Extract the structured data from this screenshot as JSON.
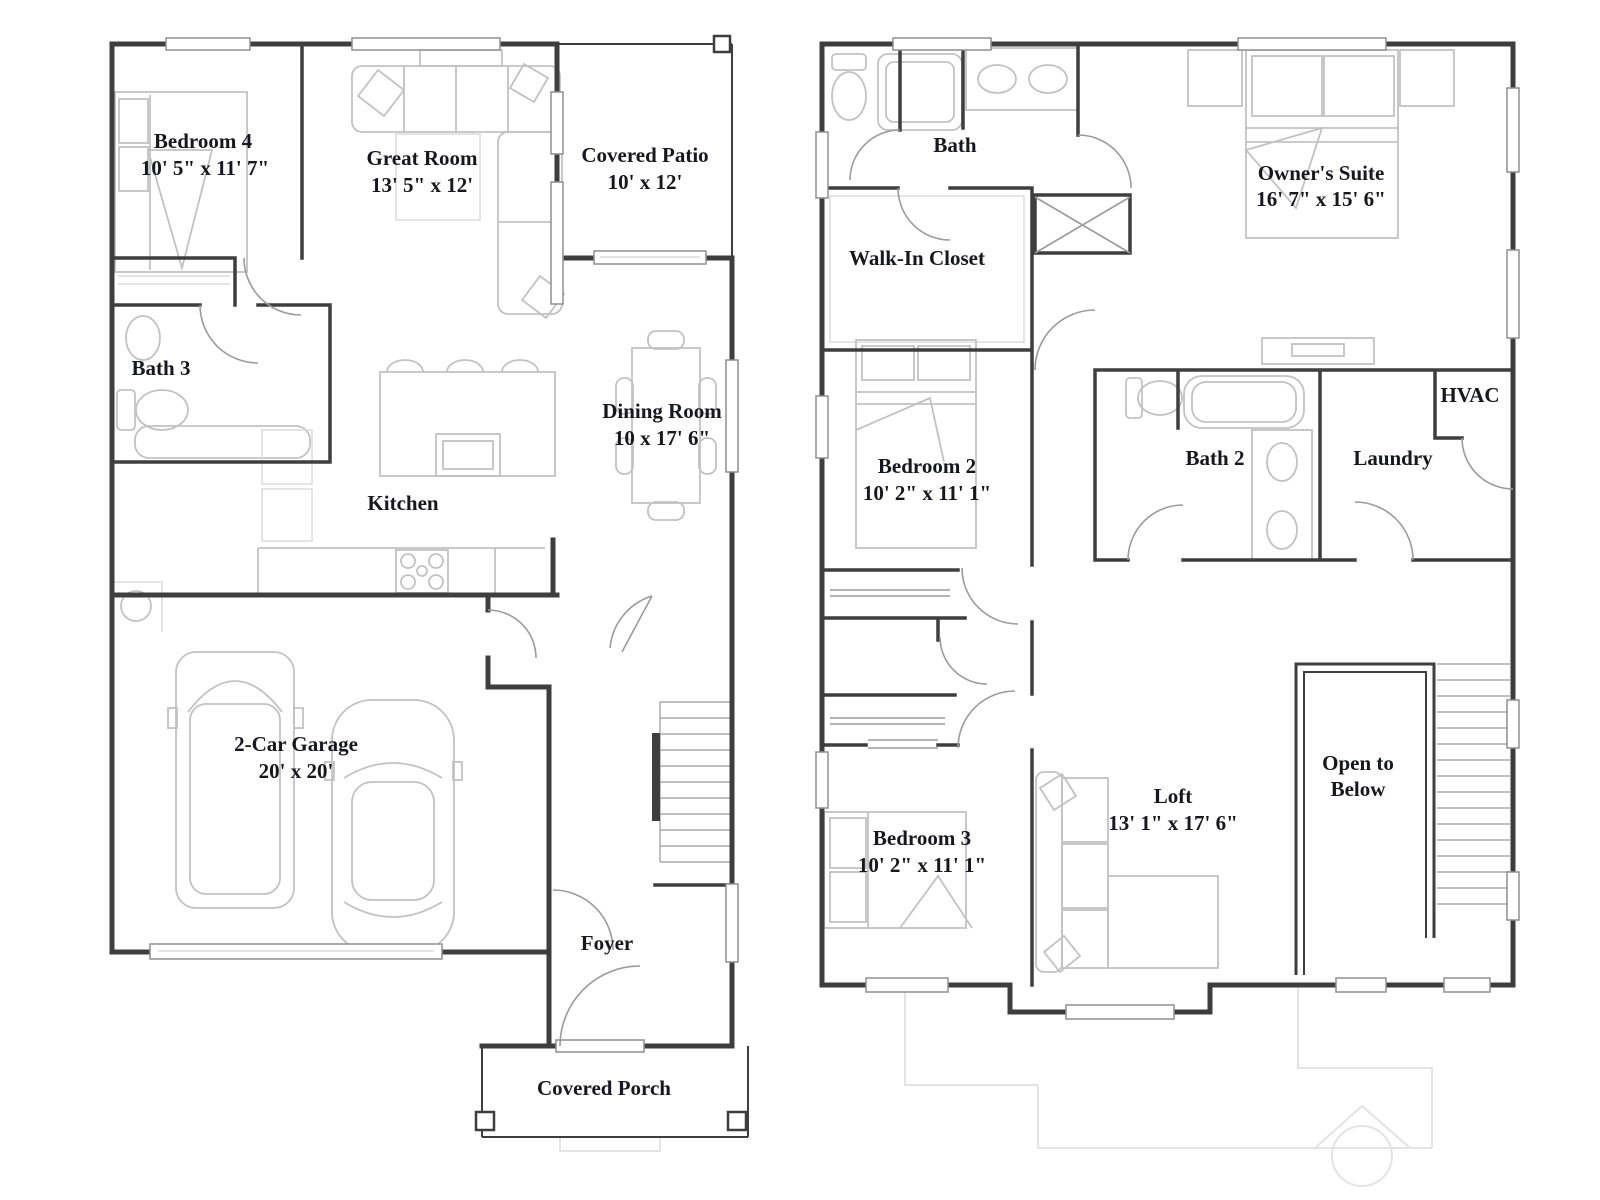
{
  "palette": {
    "background": "#ffffff",
    "wall": "#3e3e3e",
    "fixture": "#c2c2c2",
    "fixture_light": "#dcdcdc",
    "door": "#9b9b9b",
    "window_stroke": "#8f8f8f",
    "ghost": "#e3e3e3",
    "label": "#17171f"
  },
  "floor1": {
    "rooms": {
      "bedroom4": {
        "name": "Bedroom 4",
        "dims": "10' 5\" x 11' 7\""
      },
      "great_room": {
        "name": "Great Room",
        "dims": "13' 5\" x 12'"
      },
      "covered_patio": {
        "name": "Covered Patio",
        "dims": "10' x 12'"
      },
      "bath3": {
        "name": "Bath 3"
      },
      "kitchen": {
        "name": "Kitchen"
      },
      "dining_room": {
        "name": "Dining Room",
        "dims": "10 x 17' 6\""
      },
      "garage": {
        "name": "2-Car Garage",
        "dims": "20' x 20'"
      },
      "foyer": {
        "name": "Foyer"
      },
      "covered_porch": {
        "name": "Covered Porch"
      }
    }
  },
  "floor2": {
    "rooms": {
      "bath": {
        "name": "Bath"
      },
      "owners_suite": {
        "name": "Owner's Suite",
        "dims": "16' 7\" x 15' 6\""
      },
      "walk_in_closet": {
        "name": "Walk-In Closet"
      },
      "bedroom2": {
        "name": "Bedroom 2",
        "dims": "10' 2\" x 11' 1\""
      },
      "bath2": {
        "name": "Bath 2"
      },
      "laundry": {
        "name": "Laundry"
      },
      "hvac": {
        "name": "HVAC"
      },
      "bedroom3": {
        "name": "Bedroom 3",
        "dims": "10' 2\" x 11' 1\""
      },
      "loft": {
        "name": "Loft",
        "dims": "13' 1\" x 17' 6\""
      },
      "open_to_below": {
        "line1": "Open to",
        "line2": "Below"
      }
    }
  }
}
